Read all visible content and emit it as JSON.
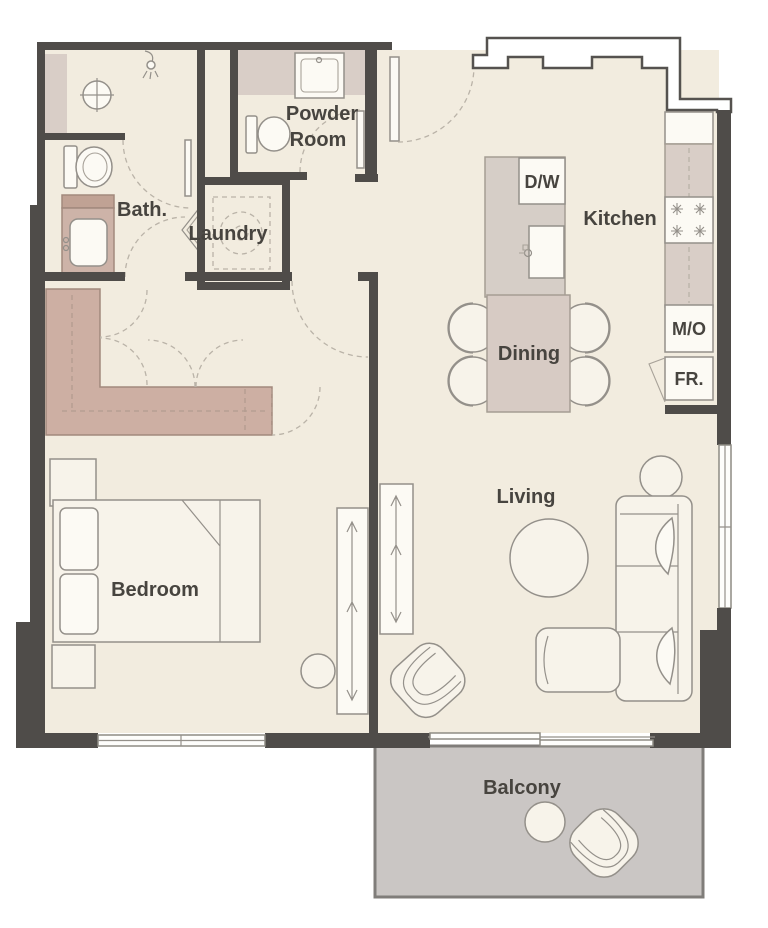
{
  "rooms": {
    "bath": {
      "label": "Bath."
    },
    "laundry": {
      "label": "Laundry"
    },
    "powder_room": {
      "label_line1": "Powder",
      "label_line2": "Room"
    },
    "kitchen": {
      "label": "Kitchen"
    },
    "dining": {
      "label": "Dining"
    },
    "living": {
      "label": "Living"
    },
    "bedroom": {
      "label": "Bedroom"
    },
    "balcony": {
      "label": "Balcony"
    }
  },
  "appliances": {
    "dishwasher": {
      "label": "D/W"
    },
    "microwave": {
      "label": "M/O"
    },
    "fridge": {
      "label": "FR."
    }
  },
  "colors": {
    "wall": "#4f4c49",
    "floor": "#f2ecdf",
    "fixture_fill": "#f7f3ea",
    "tile_mauve": "#d9cec7",
    "island_gray": "#d6cec7",
    "dining_mauve": "#d7cbc4",
    "vanity_mauve": "#cdb3a8",
    "vanity_counter": "#c0a294",
    "wardrobe_mauve": "#cdafa3",
    "balcony_gray": "#cac6c4",
    "label_text": "#47443f"
  }
}
